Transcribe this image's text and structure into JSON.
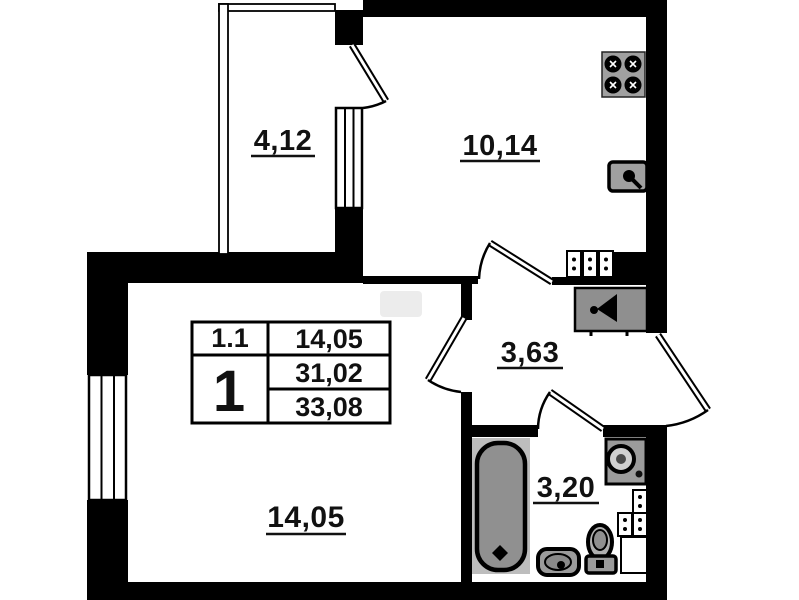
{
  "plan": {
    "rooms": {
      "balcony": {
        "area": "4,12"
      },
      "kitchen": {
        "area": "10,14"
      },
      "hallway": {
        "area": "3,63"
      },
      "bathroom": {
        "area": "3,20"
      },
      "living_room": {
        "area": "14,05"
      }
    },
    "stamp": {
      "unit_code": "1.1",
      "living_area": "14,05",
      "room_count": "1",
      "area_main": "31,02",
      "area_total": "33,08"
    },
    "fixtures": [
      "stove-icon",
      "kitchen-sink-icon",
      "electric-meter-icon",
      "intercom-icon",
      "bathtub-icon",
      "washbasin-icon",
      "toilet-icon",
      "washing-machine-icon"
    ],
    "colors": {
      "wall": "#000000",
      "background": "#ffffff",
      "fixture_gray": "#9b9b9b",
      "fixture_dark_gray": "#8f8f8f",
      "fixture_light_gray": "#bdbdbd",
      "text": "#111111"
    }
  }
}
